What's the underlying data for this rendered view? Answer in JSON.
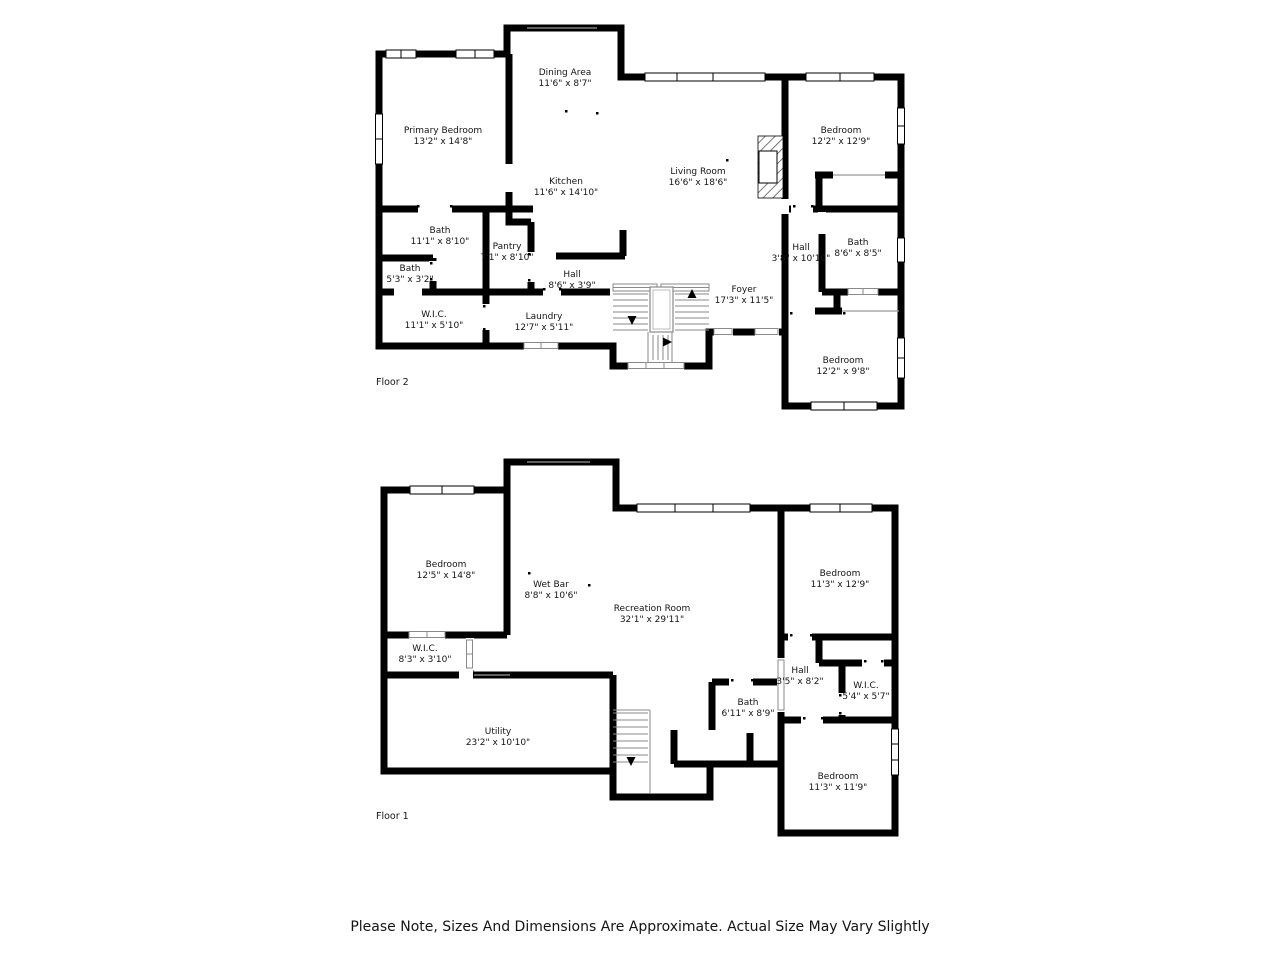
{
  "note": "Please Note, Sizes And Dimensions Are Approximate. Actual Size May Vary Slightly",
  "colors": {
    "wall": "#000000",
    "background": "#ffffff",
    "stair_lines": "#8a8a8a",
    "text": "#141414"
  },
  "floor2": {
    "label": "Floor 2",
    "rooms": [
      {
        "name": "Dining Area",
        "dims": "11'6\" x 8'7\""
      },
      {
        "name": "Primary Bedroom",
        "dims": "13'2\" x 14'8\""
      },
      {
        "name": "Bedroom",
        "dims": "12'2\" x 12'9\""
      },
      {
        "name": "Living Room",
        "dims": "16'6\" x 18'6\""
      },
      {
        "name": "Kitchen",
        "dims": "11'6\" x 14'10\""
      },
      {
        "name": "Bath",
        "dims": "11'1\" x 8'10\""
      },
      {
        "name": "Pantry",
        "dims": "7'1\" x 8'10\""
      },
      {
        "name": "Bath",
        "dims": "5'3\" x 3'2\""
      },
      {
        "name": "Hall",
        "dims": "3'8\" x 10'10\""
      },
      {
        "name": "Bath",
        "dims": "8'6\" x 8'5\""
      },
      {
        "name": "Hall",
        "dims": "8'6\" x 3'9\""
      },
      {
        "name": "Foyer",
        "dims": "17'3\" x 11'5\""
      },
      {
        "name": "W.I.C.",
        "dims": "11'1\" x 5'10\""
      },
      {
        "name": "Laundry",
        "dims": "12'7\" x 5'11\""
      },
      {
        "name": "Bedroom",
        "dims": "12'2\" x 9'8\""
      }
    ]
  },
  "floor1": {
    "label": "Floor 1",
    "rooms": [
      {
        "name": "Bedroom",
        "dims": "12'5\" x 14'8\""
      },
      {
        "name": "Wet Bar",
        "dims": "8'8\" x 10'6\""
      },
      {
        "name": "Recreation Room",
        "dims": "32'1\" x 29'11\""
      },
      {
        "name": "Bedroom",
        "dims": "11'3\" x 12'9\""
      },
      {
        "name": "W.I.C.",
        "dims": "8'3\" x 3'10\""
      },
      {
        "name": "Hall",
        "dims": "3'5\" x 8'2\""
      },
      {
        "name": "W.I.C.",
        "dims": "5'4\" x 5'7\""
      },
      {
        "name": "Bath",
        "dims": "6'11\" x 8'9\""
      },
      {
        "name": "Utility",
        "dims": "23'2\" x 10'10\""
      },
      {
        "name": "Bedroom",
        "dims": "11'3\" x 11'9\""
      }
    ]
  }
}
